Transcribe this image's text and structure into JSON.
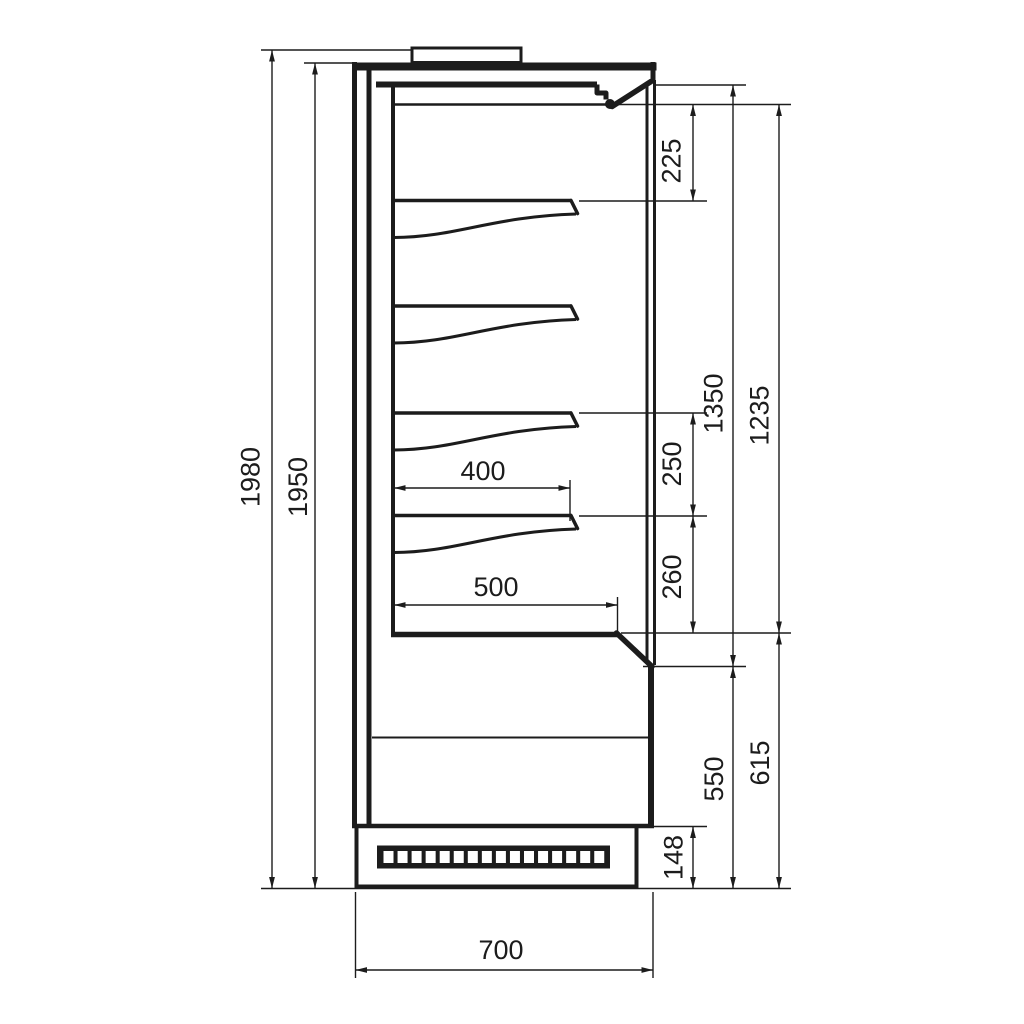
{
  "page": {
    "background": "#ffffff",
    "line_color": "#1c1c1c"
  },
  "drawing": {
    "type": "technical-dimension-drawing",
    "view": "side-section",
    "subject": "multideck display cabinet",
    "units": "mm",
    "dim_labels": {
      "overall_height": "1980",
      "body_height": "1950",
      "top_clearance": "225",
      "opening_height": "1350",
      "display_height": "1235",
      "shelf_pitch_upper": "250",
      "shelf_pitch_lower": "260",
      "base_front_height": "550",
      "deck_height": "615",
      "plinth_height": "148",
      "shelf_depth": "400",
      "deck_depth": "500",
      "overall_depth": "700"
    }
  }
}
